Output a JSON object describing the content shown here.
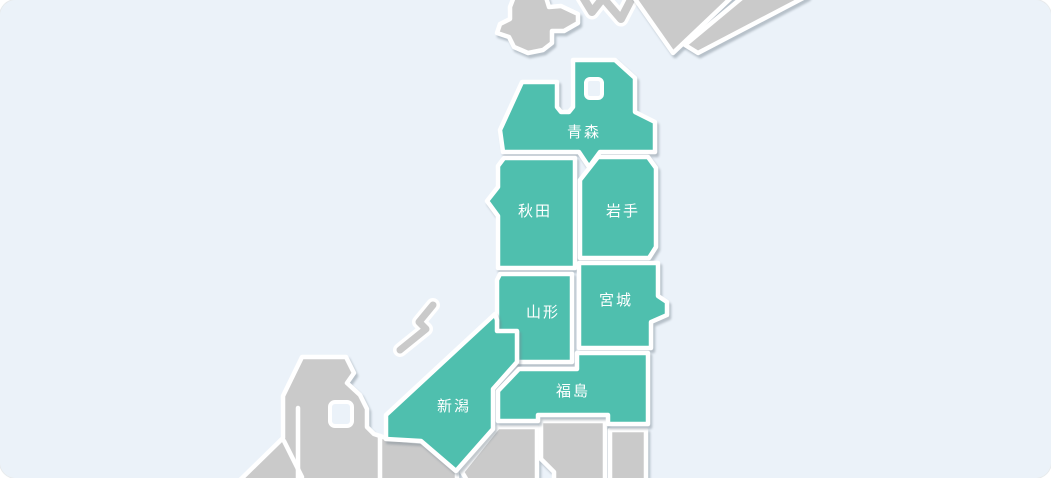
{
  "map": {
    "colors": {
      "sea": "#EBF2F9",
      "prefecture_active": "#4FBFAE",
      "land_inactive": "#CACACA",
      "border": "#FFFFFF",
      "label": "#FFFFFF"
    },
    "prefectures": [
      {
        "name": "aomori",
        "label": "青森"
      },
      {
        "name": "akita",
        "label": "秋田"
      },
      {
        "name": "iwate",
        "label": "岩手"
      },
      {
        "name": "yamagata",
        "label": "山形"
      },
      {
        "name": "miyagi",
        "label": "宮城"
      },
      {
        "name": "niigata",
        "label": "新潟"
      },
      {
        "name": "fukushima",
        "label": "福島"
      }
    ]
  }
}
